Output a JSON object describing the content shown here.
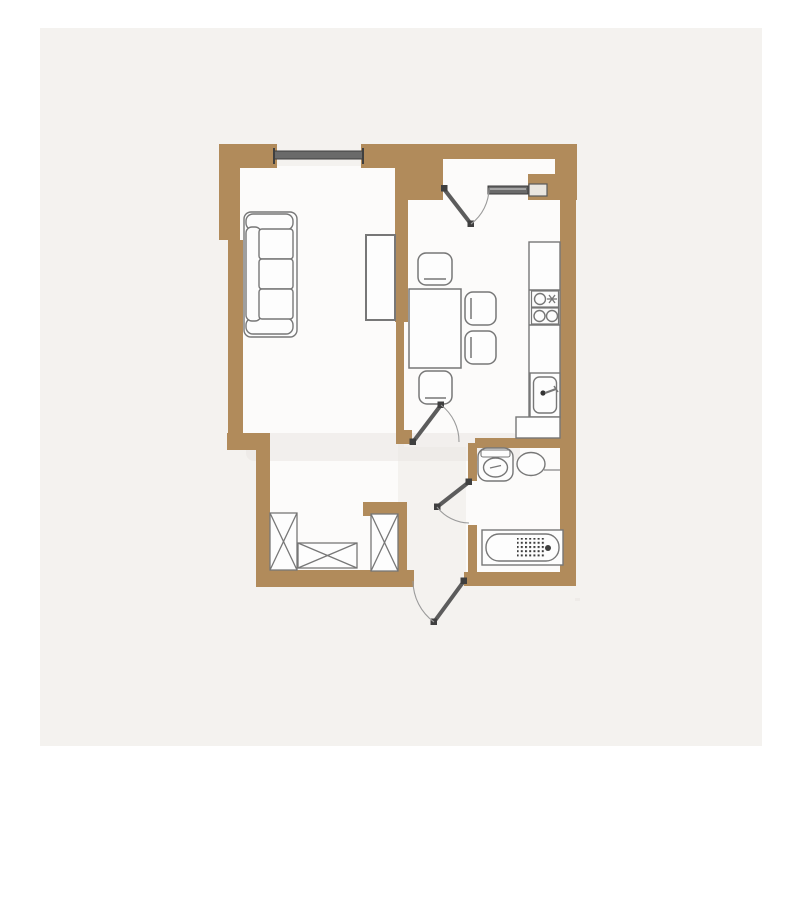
{
  "palette": {
    "page": "#ffffff",
    "panel": "#f4f2ef",
    "interior": "#fcfbfa",
    "wall": "#b18b5b",
    "outline": "#777777",
    "outline_dark": "#3f3f3f",
    "fixture": "#fdfdfd",
    "window": "#6a6a6a",
    "door": "#5c5c5c",
    "arc": "#9b9b9b",
    "watermark": "#e9e6e1"
  },
  "floorplan": {
    "type": "residential-apartment-floor-plan",
    "windows": 1,
    "doors": 4,
    "rooms": [
      {
        "name": "living-room",
        "fixtures": [
          "sofa",
          "window",
          "cabinet"
        ]
      },
      {
        "name": "kitchen",
        "fixtures": [
          "dining-table",
          "stool-top",
          "stool-right-upper",
          "stool-right-lower",
          "stool-bottom",
          "counter",
          "cooktop-single-burner",
          "cooktop-double-burner",
          "sink",
          "appliance"
        ]
      },
      {
        "name": "entrance-niche",
        "fixtures": [
          "entrance-door",
          "sidelight-panel"
        ]
      },
      {
        "name": "hallway",
        "fixtures": [
          "wardrobe-left",
          "chest-of-drawers",
          "wardrobe-right",
          "kitchen-door",
          "bathroom-door",
          "exterior-door"
        ]
      },
      {
        "name": "bathroom",
        "fixtures": [
          "toilet",
          "wash-basin",
          "bathtub"
        ]
      }
    ]
  }
}
